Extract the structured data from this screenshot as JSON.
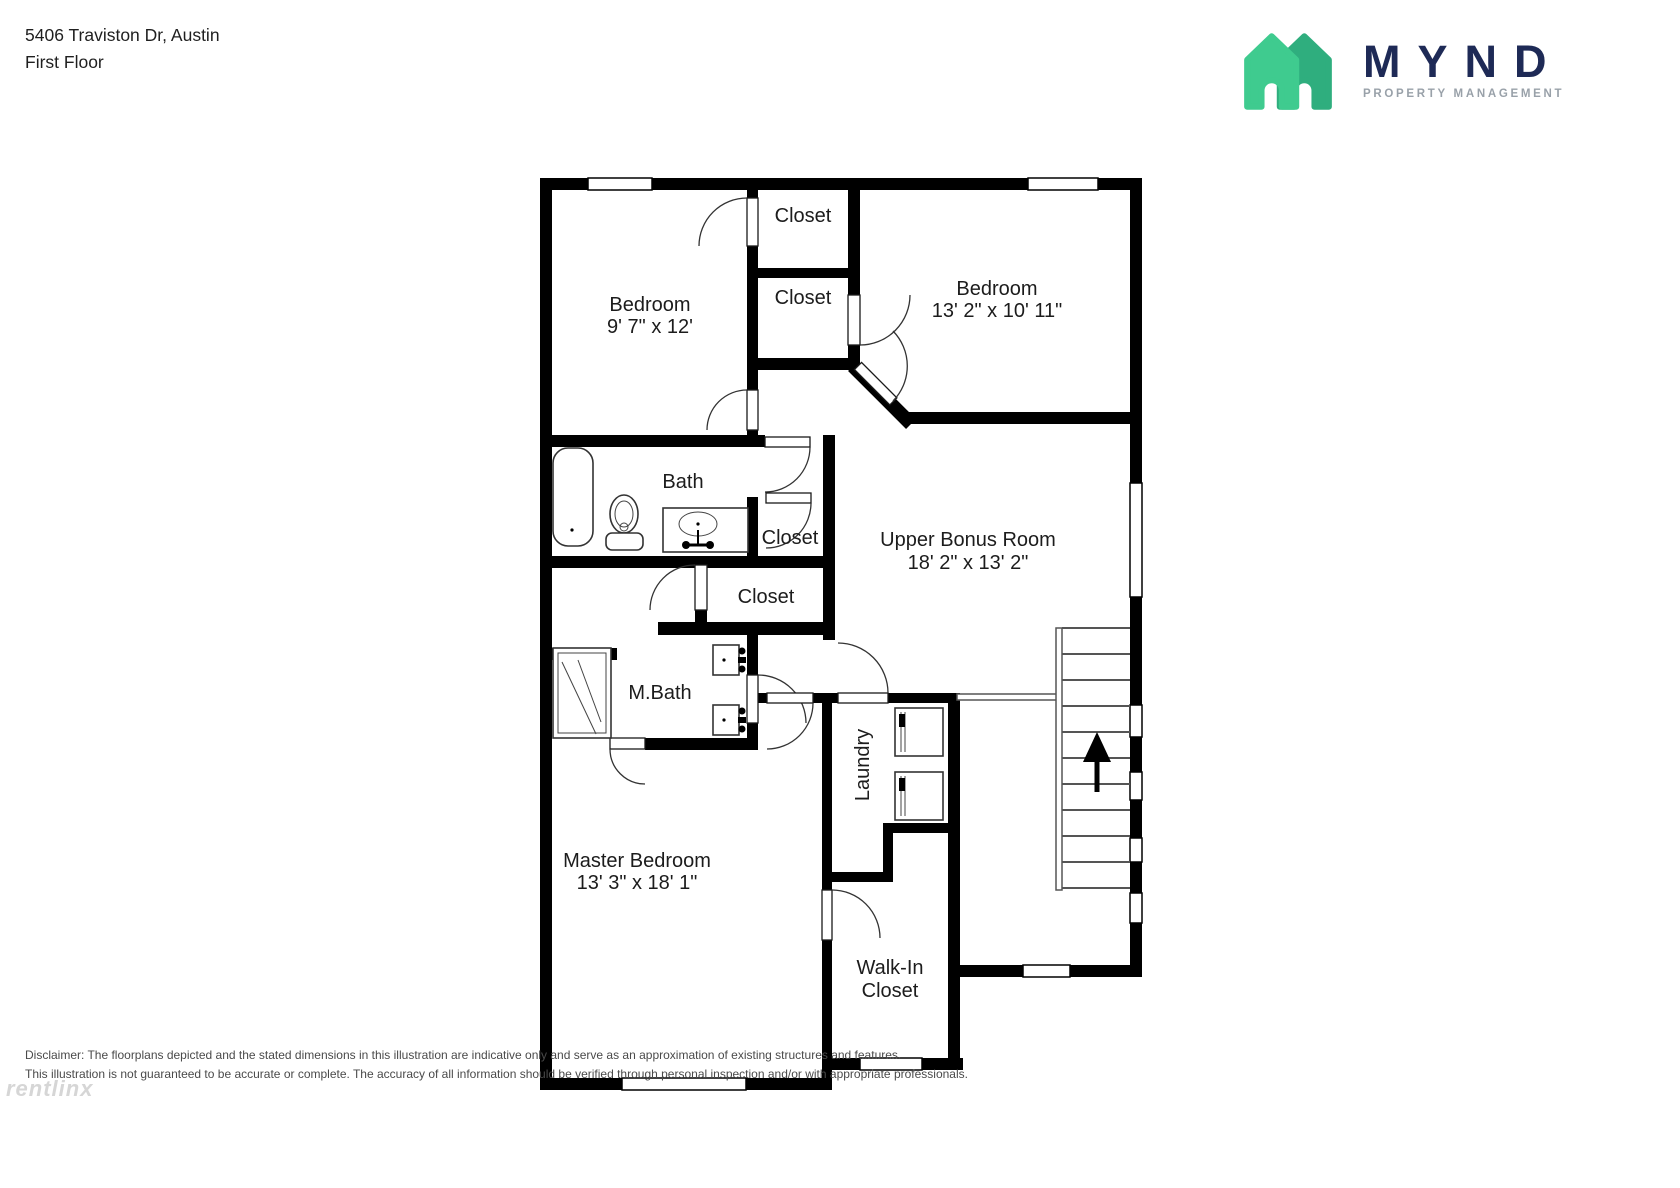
{
  "header": {
    "address": "5406 Traviston Dr, Austin",
    "floor": "First Floor"
  },
  "logo": {
    "wordmark": "MYND",
    "tagline": "PROPERTY MANAGEMENT",
    "colors": {
      "house_light": "#3FCB8F",
      "house_dark": "#2FAE7E",
      "wordmark_navy": "#1E2A56",
      "tagline_gray": "#99A1A9"
    }
  },
  "rooms": {
    "bedroom_top_left": {
      "name": "Bedroom",
      "dims": "9' 7\" x 12'"
    },
    "bedroom_top_right": {
      "name": "Bedroom",
      "dims": "13' 2\" x 10' 11\""
    },
    "upper_bonus": {
      "name": "Upper Bonus Room",
      "dims": "18' 2\" x 13' 2\""
    },
    "master": {
      "name": "Master Bedroom",
      "dims": "13' 3\" x 18' 1\""
    },
    "bath": {
      "name": "Bath"
    },
    "master_bath": {
      "name": "M.Bath"
    },
    "laundry": {
      "name": "Laundry"
    },
    "walk_in_closet": {
      "line1": "Walk-In",
      "line2": "Closet"
    },
    "closet_top_1": {
      "name": "Closet"
    },
    "closet_top_2": {
      "name": "Closet"
    },
    "closet_mid_upper": {
      "name": "Closet"
    },
    "closet_mid_lower": {
      "name": "Closet"
    }
  },
  "disclaimer": {
    "line1": "Disclaimer: The floorplans depicted and the stated dimensions in this illustration are indicative only and serve as an approximation of existing structures and features.",
    "line2": "This illustration is not guaranteed to be accurate or complete. The accuracy of all information should be verified through personal inspection and/or with appropriate professionals."
  },
  "watermark": "rentlinx"
}
